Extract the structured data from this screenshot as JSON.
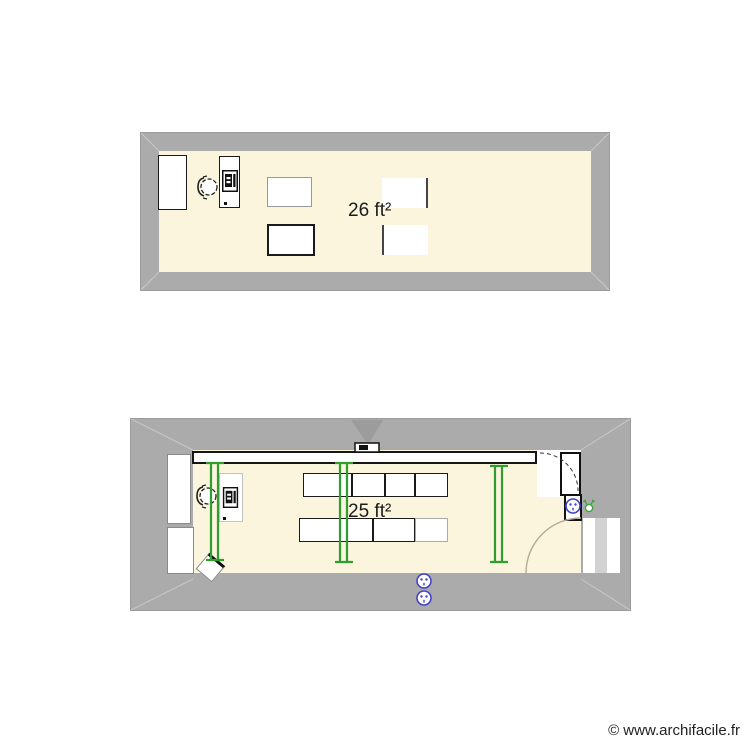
{
  "watermark": {
    "text": "© www.archifacile.fr"
  },
  "colors": {
    "wall": "#ababab",
    "wall_miter": "#c9c9c9",
    "floor": "#fbf5dd",
    "fixture_green": "#2f9e2f",
    "electric_blue": "#4242c8",
    "door_arc_light": "#b5a895",
    "line_dark": "#1a1a1a"
  },
  "plans": [
    {
      "name": "upper-room",
      "area_label": "26 ft²",
      "furniture": [
        "cabinet",
        "office-chair",
        "computer-desk",
        "table",
        "table",
        "table",
        "table"
      ]
    },
    {
      "name": "lower-room",
      "area_label": "25 ft²",
      "furniture": [
        "whiteboard",
        "video-projector",
        "fluorescent-tube",
        "fluorescent-tube",
        "fluorescent-tube",
        "computer-desk",
        "office-chair",
        "student-table-row",
        "student-table-row",
        "waste-bin",
        "door",
        "door",
        "power-socket",
        "power-socket",
        "power-socket",
        "wall-light",
        "window",
        "window"
      ]
    }
  ]
}
